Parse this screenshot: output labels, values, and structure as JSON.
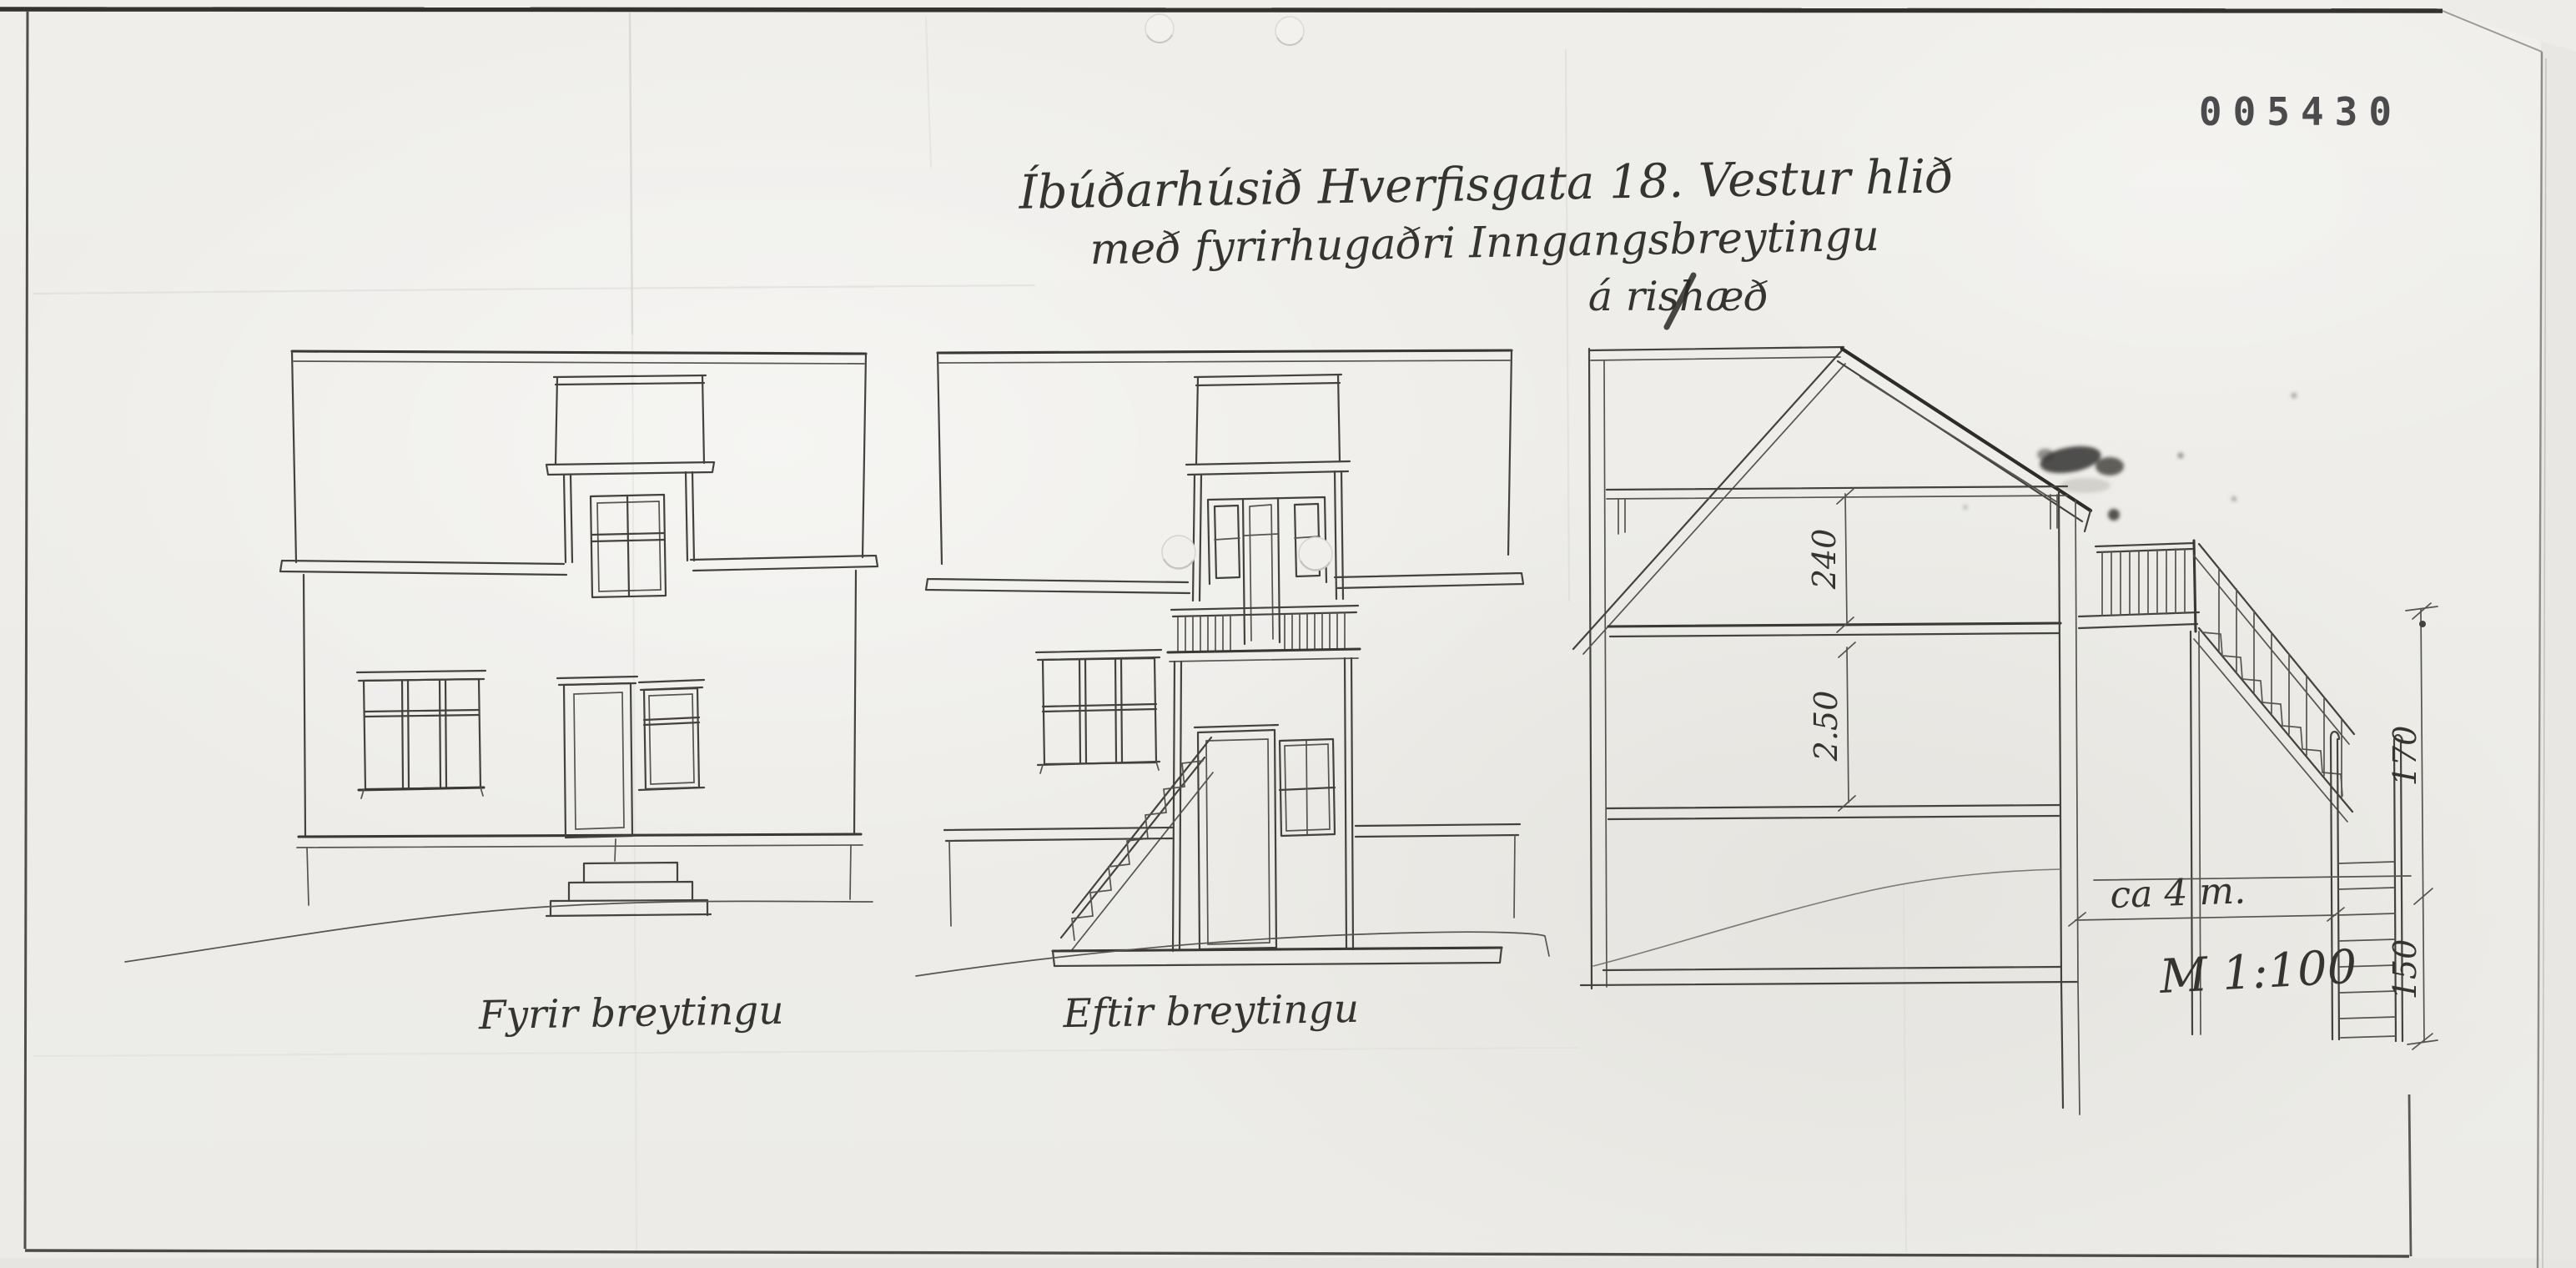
{
  "doc": {
    "stamp_number": "005430",
    "title": {
      "line1": "Íbúðarhúsið Hverfisgata 18. Vestur hlið",
      "line2": "með fyrirhugaðri Inngangsbreytingu",
      "line3": "á rishæð"
    },
    "drawings": [
      {
        "id": "elevation-before",
        "caption": "Fyrir breytingu"
      },
      {
        "id": "elevation-after",
        "caption": "Eftir breytingu"
      },
      {
        "id": "cross-section",
        "caption": ""
      }
    ],
    "dimensions": {
      "attic_height": "240",
      "floor_height": "2.50",
      "stair_upper": "170",
      "stair_lower": "150",
      "stair_width": "ca 4 m.",
      "scale": "M 1:100"
    },
    "colors": {
      "paper": "#eeede9",
      "ink": "#45423d",
      "stamp": "#4b4b4d"
    }
  }
}
